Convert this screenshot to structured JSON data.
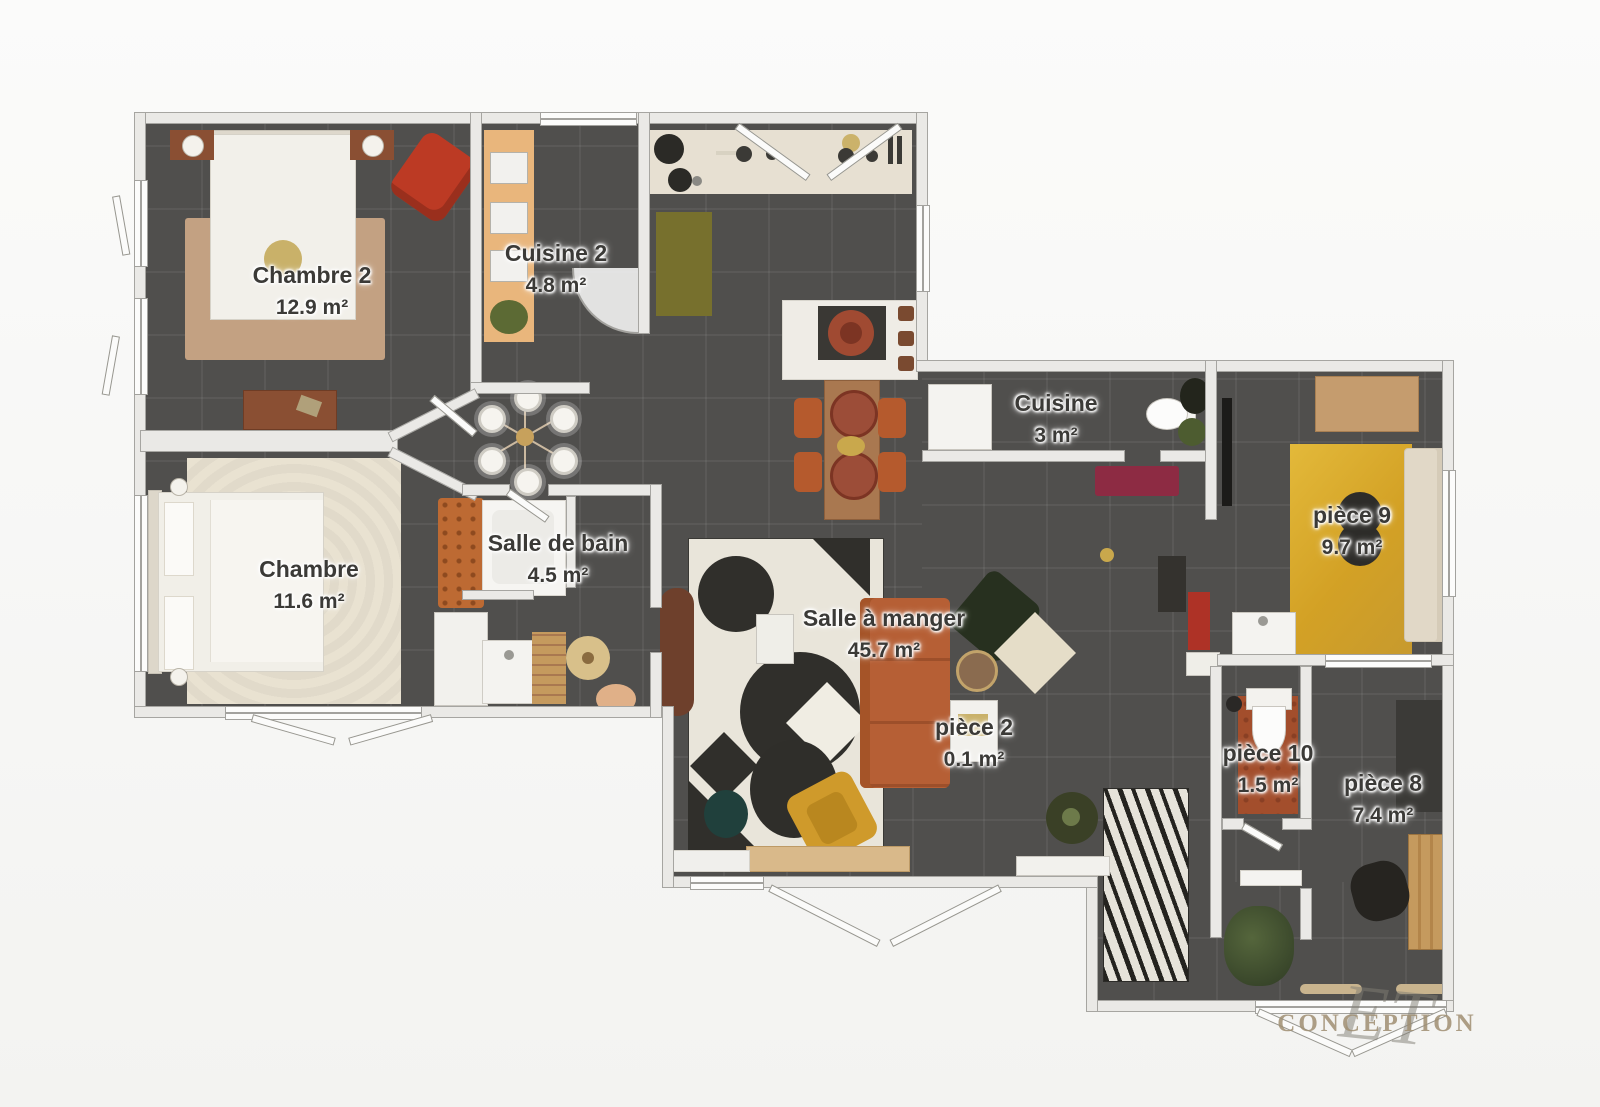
{
  "document": {
    "type": "floor-plan",
    "language": "fr"
  },
  "rooms": [
    {
      "id": "chambre-2",
      "name": "Chambre 2",
      "area": "12.9 m²"
    },
    {
      "id": "cuisine-2",
      "name": "Cuisine 2",
      "area": "4.8 m²"
    },
    {
      "id": "cuisine",
      "name": "Cuisine",
      "area": "3 m²"
    },
    {
      "id": "chambre",
      "name": "Chambre",
      "area": "11.6 m²"
    },
    {
      "id": "salle-de-bain",
      "name": "Salle de bain",
      "area": "4.5 m²"
    },
    {
      "id": "salle-a-manger",
      "name": "Salle à manger",
      "area": "45.7 m²"
    },
    {
      "id": "piece-2",
      "name": "pièce 2",
      "area": "0.1 m²"
    },
    {
      "id": "piece-9",
      "name": "pièce 9",
      "area": "9.7 m²"
    },
    {
      "id": "piece-10",
      "name": "pièce 10",
      "area": "1.5 m²"
    },
    {
      "id": "piece-8",
      "name": "pièce 8",
      "area": "7.4 m²"
    }
  ],
  "watermark": {
    "script": "ET",
    "text": "CONCEPTION"
  },
  "colors": {
    "background": "#f5f5f3",
    "floor": "#504f4d",
    "wall": "#eae9e6",
    "label_text": "#3b3a37",
    "rug_tan": "#c3a182",
    "rug_cream": "#e9e2d1",
    "rug_yellow": "#d8a62d",
    "sofa_terracotta": "#b65f35",
    "armchair_red": "#bc3a24",
    "armchair_mustard": "#cf9a2b",
    "bench_maroon": "#8d2b43",
    "rug_olive": "#77702d",
    "wood": "#a97850",
    "watermark": "#a08f72"
  }
}
